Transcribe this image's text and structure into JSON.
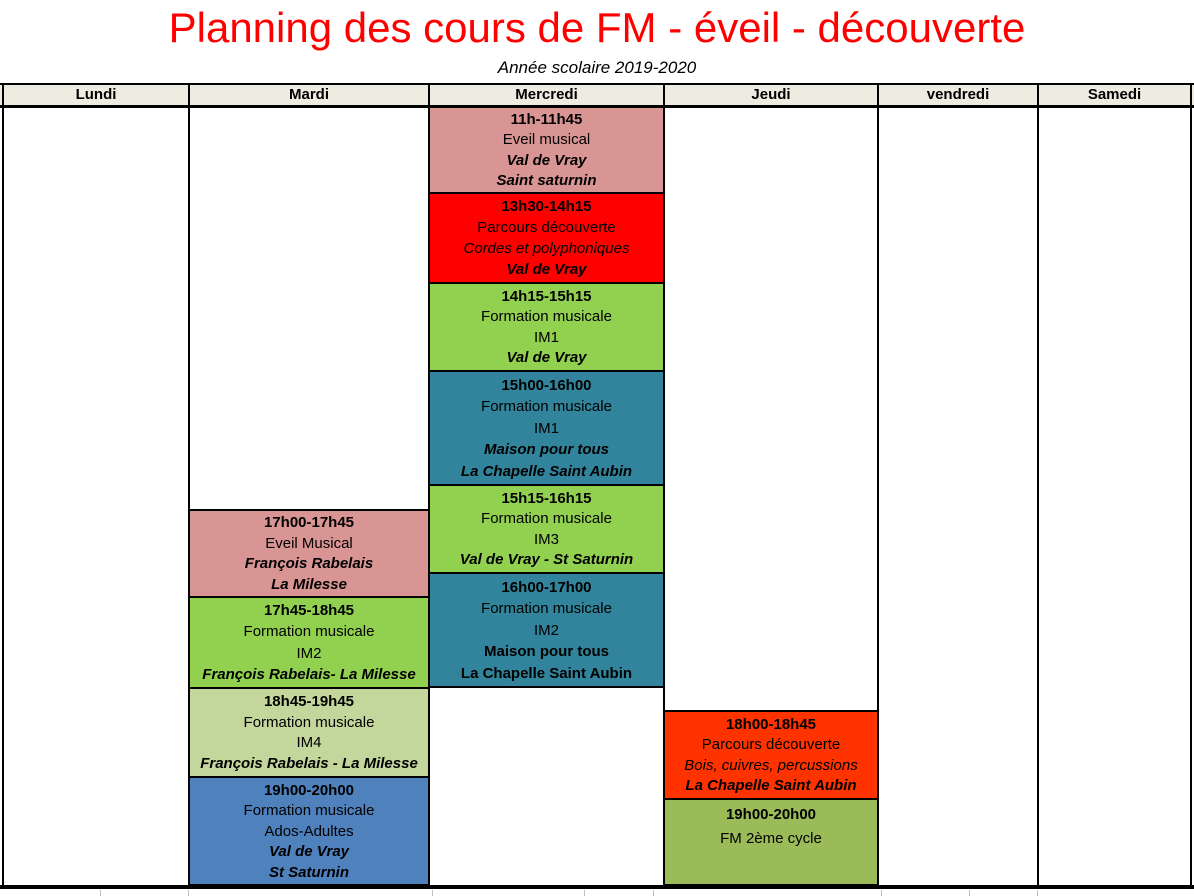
{
  "title": "Planning des cours de FM - éveil - découverte",
  "subtitle": "Année scolaire 2019-2020",
  "columns": [
    {
      "id": "lundi",
      "label": "Lundi"
    },
    {
      "id": "mardi",
      "label": "Mardi"
    },
    {
      "id": "mercredi",
      "label": "Mercredi"
    },
    {
      "id": "jeudi",
      "label": "Jeudi"
    },
    {
      "id": "vendredi",
      "label": "vendredi"
    },
    {
      "id": "samedi",
      "label": "Samedi"
    }
  ],
  "colors": {
    "title_red": "#FF0000",
    "header_bg": "#EEECE1",
    "pink": "#D99594",
    "red": "#FF0000",
    "green": "#92D050",
    "teal": "#31849B",
    "light_olive": "#C3D69B",
    "blue": "#4F81BD",
    "orange_red": "#FF3300",
    "olive": "#9BBB59"
  },
  "events": [
    {
      "day": "mercredi",
      "color": "pink",
      "lines": [
        {
          "kind": "time",
          "text": "11h-11h45"
        },
        {
          "kind": "course",
          "text": "Eveil musical"
        },
        {
          "kind": "venue",
          "text": "Val de Vray"
        },
        {
          "kind": "venue",
          "text": "Saint saturnin"
        }
      ]
    },
    {
      "day": "mercredi",
      "color": "red",
      "lines": [
        {
          "kind": "time",
          "text": "13h30-14h15"
        },
        {
          "kind": "course",
          "text": "Parcours découverte"
        },
        {
          "kind": "detail",
          "text": "Cordes et polyphoniques"
        },
        {
          "kind": "venue",
          "text": "Val de Vray"
        }
      ]
    },
    {
      "day": "mercredi",
      "color": "green",
      "lines": [
        {
          "kind": "time",
          "text": "14h15-15h15"
        },
        {
          "kind": "course",
          "text": "Formation musicale"
        },
        {
          "kind": "level",
          "text": "IM1"
        },
        {
          "kind": "venue",
          "text": "Val de Vray"
        }
      ]
    },
    {
      "day": "mercredi",
      "color": "teal",
      "lines": [
        {
          "kind": "time",
          "text": "15h00-16h00"
        },
        {
          "kind": "course",
          "text": "Formation musicale"
        },
        {
          "kind": "level",
          "text": "IM1"
        },
        {
          "kind": "venue",
          "text": "Maison pour tous"
        },
        {
          "kind": "venue",
          "text": "La Chapelle Saint Aubin"
        }
      ]
    },
    {
      "day": "mercredi",
      "color": "green",
      "lines": [
        {
          "kind": "time",
          "text": "15h15-16h15"
        },
        {
          "kind": "course",
          "text": "Formation musicale"
        },
        {
          "kind": "level",
          "text": "IM3"
        },
        {
          "kind": "venue",
          "text": "Val de Vray - St Saturnin"
        }
      ]
    },
    {
      "day": "mercredi",
      "color": "teal",
      "lines": [
        {
          "kind": "time",
          "text": "16h00-17h00"
        },
        {
          "kind": "course",
          "text": "Formation musicale"
        },
        {
          "kind": "level",
          "text": "IM2"
        },
        {
          "kind": "venue-upright",
          "text": "Maison pour tous"
        },
        {
          "kind": "venue-upright",
          "text": "La Chapelle Saint Aubin"
        }
      ]
    },
    {
      "day": "mardi",
      "color": "pink",
      "lines": [
        {
          "kind": "time",
          "text": "17h00-17h45"
        },
        {
          "kind": "course",
          "text": "Eveil Musical"
        },
        {
          "kind": "venue",
          "text": "François Rabelais"
        },
        {
          "kind": "venue",
          "text": "La Milesse"
        }
      ]
    },
    {
      "day": "mardi",
      "color": "green",
      "lines": [
        {
          "kind": "time",
          "text": "17h45-18h45"
        },
        {
          "kind": "course",
          "text": "Formation musicale"
        },
        {
          "kind": "level",
          "text": "IM2"
        },
        {
          "kind": "venue",
          "text": "François Rabelais- La Milesse"
        }
      ]
    },
    {
      "day": "mardi",
      "color": "light_olive",
      "lines": [
        {
          "kind": "time",
          "text": "18h45-19h45"
        },
        {
          "kind": "course",
          "text": "Formation musicale"
        },
        {
          "kind": "level",
          "text": "IM4"
        },
        {
          "kind": "venue",
          "text": "François Rabelais - La Milesse"
        }
      ]
    },
    {
      "day": "mardi",
      "color": "blue",
      "lines": [
        {
          "kind": "time",
          "text": "19h00-20h00"
        },
        {
          "kind": "course",
          "text": "Formation musicale"
        },
        {
          "kind": "level",
          "text": "Ados-Adultes"
        },
        {
          "kind": "venue",
          "text": "Val de Vray"
        },
        {
          "kind": "venue",
          "text": "St Saturnin"
        }
      ]
    },
    {
      "day": "jeudi",
      "color": "orange_red",
      "lines": [
        {
          "kind": "time",
          "text": "18h00-18h45"
        },
        {
          "kind": "course",
          "text": "Parcours découverte"
        },
        {
          "kind": "detail",
          "text": "Bois, cuivres, percussions"
        },
        {
          "kind": "venue",
          "text": "La Chapelle Saint Aubin"
        }
      ]
    },
    {
      "day": "jeudi",
      "color": "olive",
      "lines": [
        {
          "kind": "time",
          "text": "19h00-20h00"
        },
        {
          "kind": "course",
          "text": "FM 2ème cycle"
        }
      ]
    }
  ]
}
